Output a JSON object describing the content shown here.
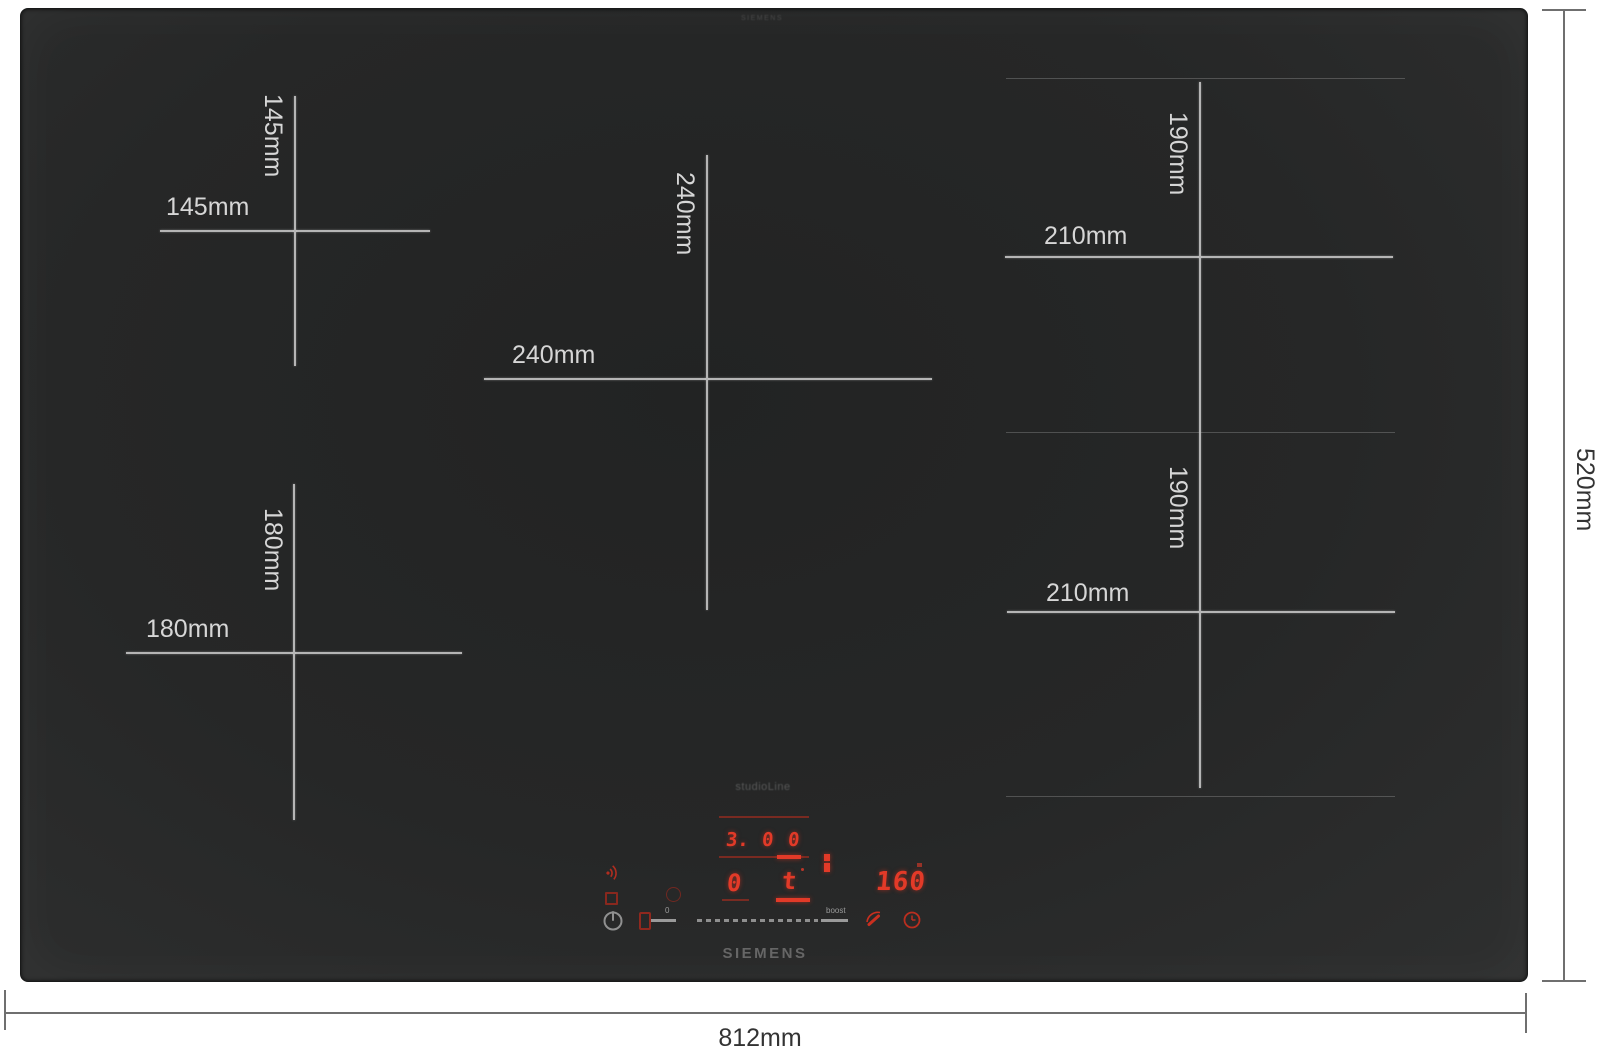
{
  "product": {
    "brand": "SIEMENS",
    "sub_brand": "studioLine",
    "edge_etch": "SIEMENS"
  },
  "overall_dimensions": {
    "width": "812mm",
    "depth": "520mm"
  },
  "zones": [
    {
      "id": "rear-left",
      "width": "145mm",
      "depth": "145mm"
    },
    {
      "id": "front-left",
      "width": "180mm",
      "depth": "180mm"
    },
    {
      "id": "center",
      "width": "240mm",
      "depth": "240mm"
    },
    {
      "id": "rear-right",
      "width": "210mm",
      "depth": "190mm"
    },
    {
      "id": "front-right",
      "width": "210mm",
      "depth": "190mm"
    }
  ],
  "control_panel": {
    "power_display_digits": [
      "3.",
      "0",
      "0"
    ],
    "zone_display_left": "0",
    "zone_display_right": "t",
    "timer_display": "160",
    "slider_min_label": "0",
    "slider_max_label": "boost"
  },
  "colors": {
    "led_red": "#e23a28",
    "led_red_dim": "#9a2418",
    "crosshair_gray": "#b5b5b5",
    "glass_black": "#262727",
    "bracket_gray": "#6f6f6f",
    "zone_label_light": "#d6d6d6",
    "dim_label_dark": "#333333"
  }
}
